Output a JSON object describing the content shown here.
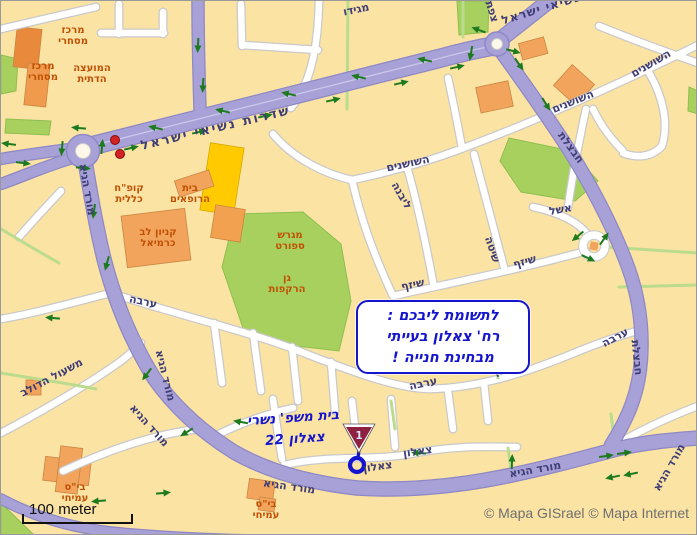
{
  "colors": {
    "background": "#FBE3A4",
    "road_purple": "#A7A1D7",
    "road_purple_edge": "#8E88C5",
    "road_white": "#FFFFFF",
    "road_casing": "#C9C9C9",
    "park_green": "#A8D05F",
    "path_green": "#BADC8C",
    "building_orange": "#F2A45C",
    "building_yellow": "#FFCB00",
    "ink_blue": "#1515CD",
    "street_label_navy": "#3E3D75",
    "poi_red": "#C05004",
    "arrow_green": "#1E7A1E",
    "marker_red": "#8E2040",
    "scale_text_black": "#111111",
    "attribution_gray": "#6F6F6F"
  },
  "labels": {
    "streets": [
      "שדרות נשיאי ישראל",
      "שדרות נשיאי ישראל",
      "מגידו",
      "צפת",
      "מורד הגיא",
      "מורד הגיא",
      "מורד הגיא",
      "מורד הגיא",
      "מורד הגיא",
      "מורד הגיא",
      "השושנים",
      "השושנים",
      "השושנים",
      "חבצלת",
      "חבצלת",
      "אשל",
      "ליבנה",
      "שיטה",
      "שיזף",
      "שיזף",
      "ערבה",
      "ערבה",
      "ערבה",
      "ערבה",
      "צאלון",
      "צאלון",
      "משעול הדולב"
    ],
    "pois": [
      {
        "line1": "מרכז",
        "line2": "מסחרי"
      },
      {
        "line1": "מרכז",
        "line2": "מסחרי"
      },
      {
        "line1": "המועצה",
        "line2": "הדתית"
      },
      {
        "line1": "קופ\"ח",
        "line2": "כללית"
      },
      {
        "line1": "בית",
        "line2": "הרופאים"
      },
      {
        "line1": "קניון לב",
        "line2": "כרמיאל"
      },
      {
        "line1": "מגרש",
        "line2": "ספורט"
      },
      {
        "line1": "גן",
        "line2": "הרקפות"
      },
      {
        "line1": "בי\"ס",
        "line2": "עמיחי"
      },
      {
        "line1": "בי\"ס",
        "line2": "עמיחי"
      }
    ]
  },
  "annotation": {
    "line1": "לתשומת ליבכם :",
    "line2": "רח' צאלון בעייתי",
    "line3": "מבחינת חנייה !"
  },
  "note": {
    "line1": "בית משפ' נשרי",
    "line2": "צאלון 22"
  },
  "marker": {
    "number": "1"
  },
  "scale_bar": {
    "label": "100 meter"
  },
  "attribution": {
    "text": "© Mapa GISrael © Mapa Internet"
  }
}
